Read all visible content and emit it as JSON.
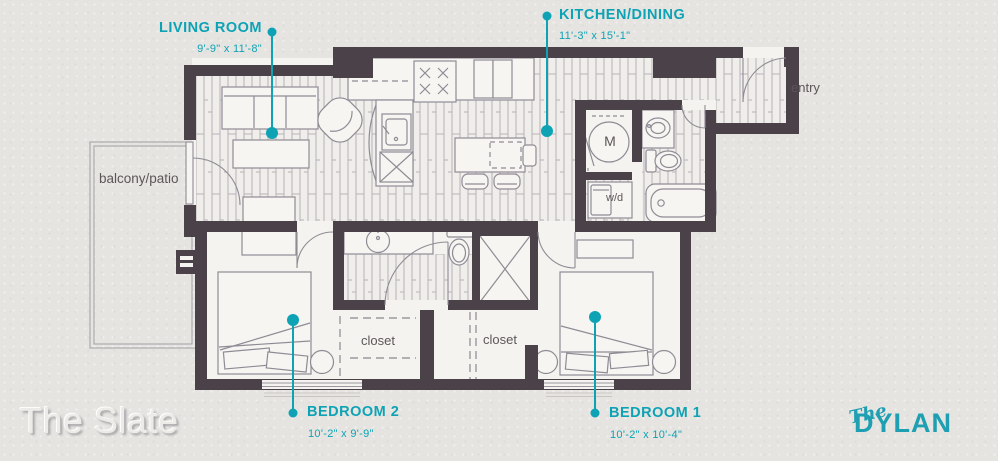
{
  "plan": {
    "title": "The Slate",
    "brand": {
      "script": "The",
      "name": "DYLAN"
    },
    "rooms": [
      {
        "id": "living-room",
        "label": "LIVING ROOM",
        "dimensions": "9'-9\" x 11'-8\""
      },
      {
        "id": "kitchen-dining",
        "label": "KITCHEN/DINING",
        "dimensions": "11'-3\" x 15'-1\""
      },
      {
        "id": "bedroom-2",
        "label": "BEDROOM 2",
        "dimensions": "10'-2\" x 9'-9\""
      },
      {
        "id": "bedroom-1",
        "label": "BEDROOM 1",
        "dimensions": "10'-2\" x 10'-4\""
      }
    ],
    "annotations": {
      "balcony": "balcony/patio",
      "entry": "entry",
      "washer_dryer": "w/d",
      "mechanical": "M",
      "closet_a": "closet",
      "closet_b": "closet"
    },
    "colors": {
      "accent": "#0da3b5",
      "wall": "#4a4149",
      "background": "#e6e4e1"
    }
  }
}
